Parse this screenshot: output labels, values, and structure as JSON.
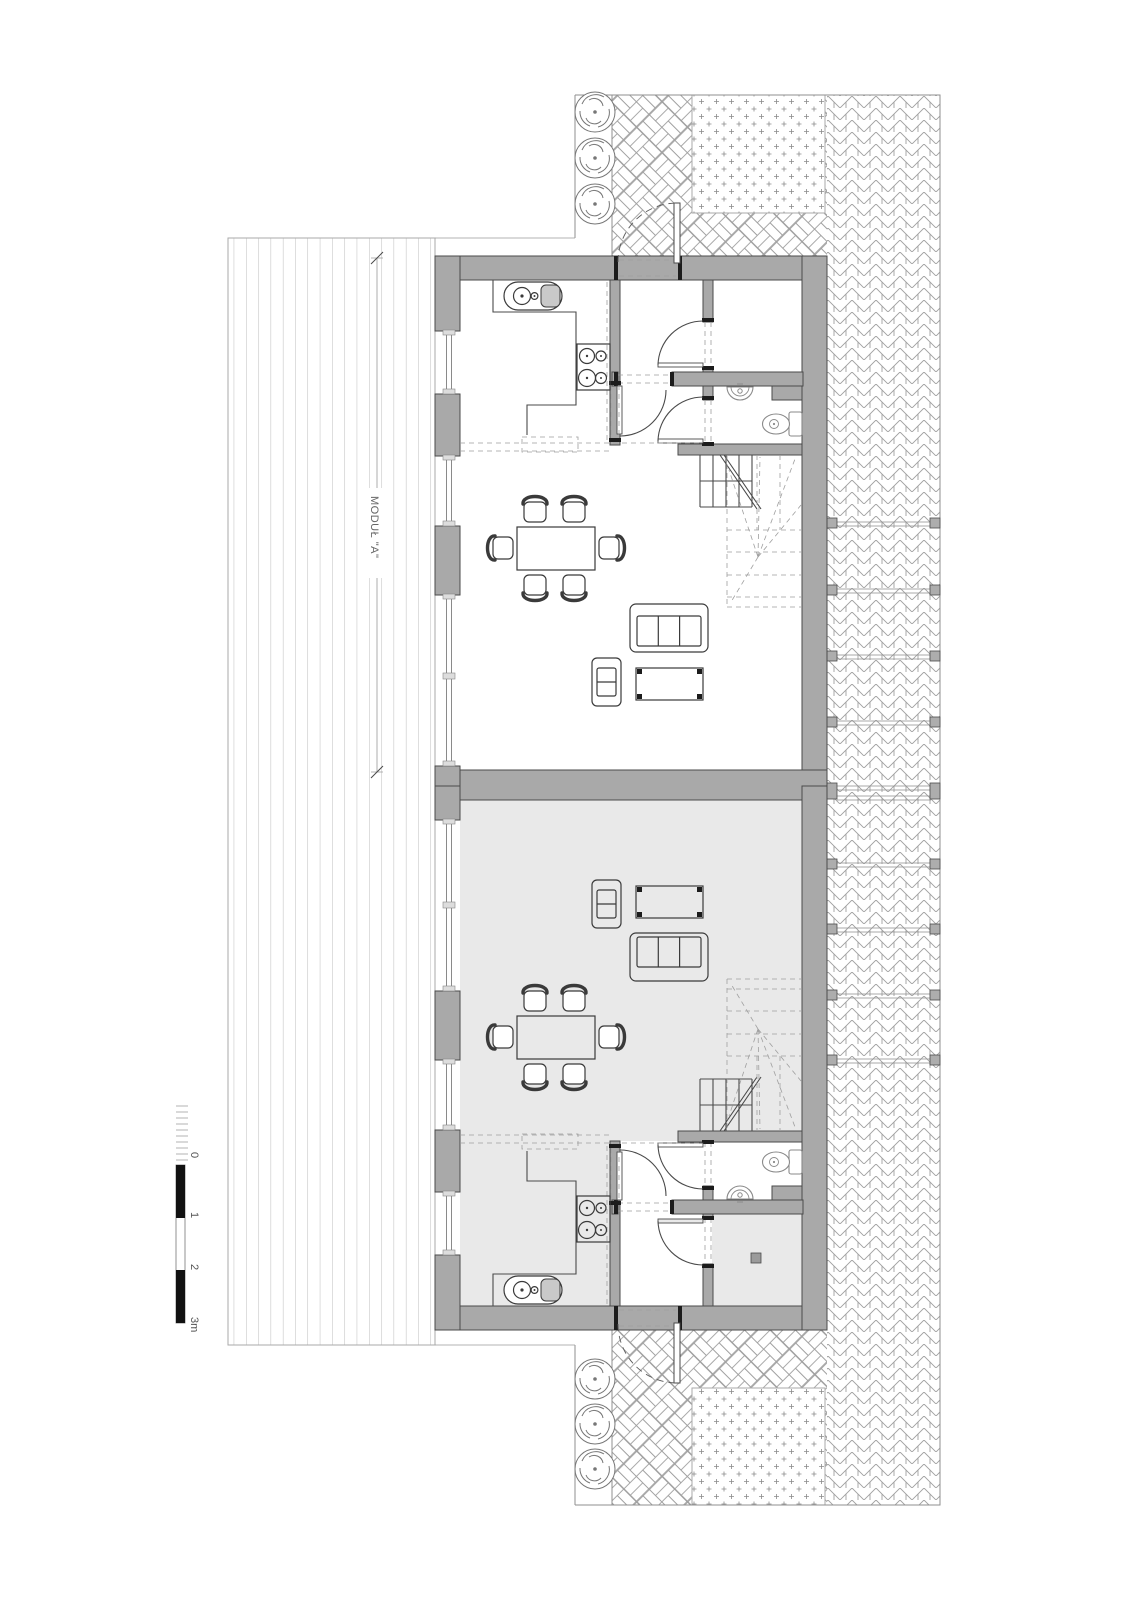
{
  "drawing": {
    "type": "architectural floor plan, twin residential modules with deck and paved garden",
    "module_label": "MODUŁ \"A\""
  },
  "scale_bar": {
    "ticks": [
      "0",
      "1",
      "2",
      "3m"
    ]
  },
  "colors": {
    "wall_gray": "#a9a9a9",
    "module_b_floor": "#e9e9e9",
    "paving_line": "#a0a0a0",
    "drawing_line": "#4a4a4a",
    "scale_black": "#111111"
  },
  "icons": {
    "tree": "tree-icon (swirl foliage symbol, 6x)",
    "kitchen_sink": "kitchen-sink-icon (2x)",
    "cooktop": "cooktop-icon (2x)",
    "toilet": "toilet-icon (2x)",
    "bath_sink": "bath-sink-icon (2x)",
    "stairs": "winder-stair symbol (2x)",
    "fence_post": "fence-post (10 garden dividers)"
  }
}
